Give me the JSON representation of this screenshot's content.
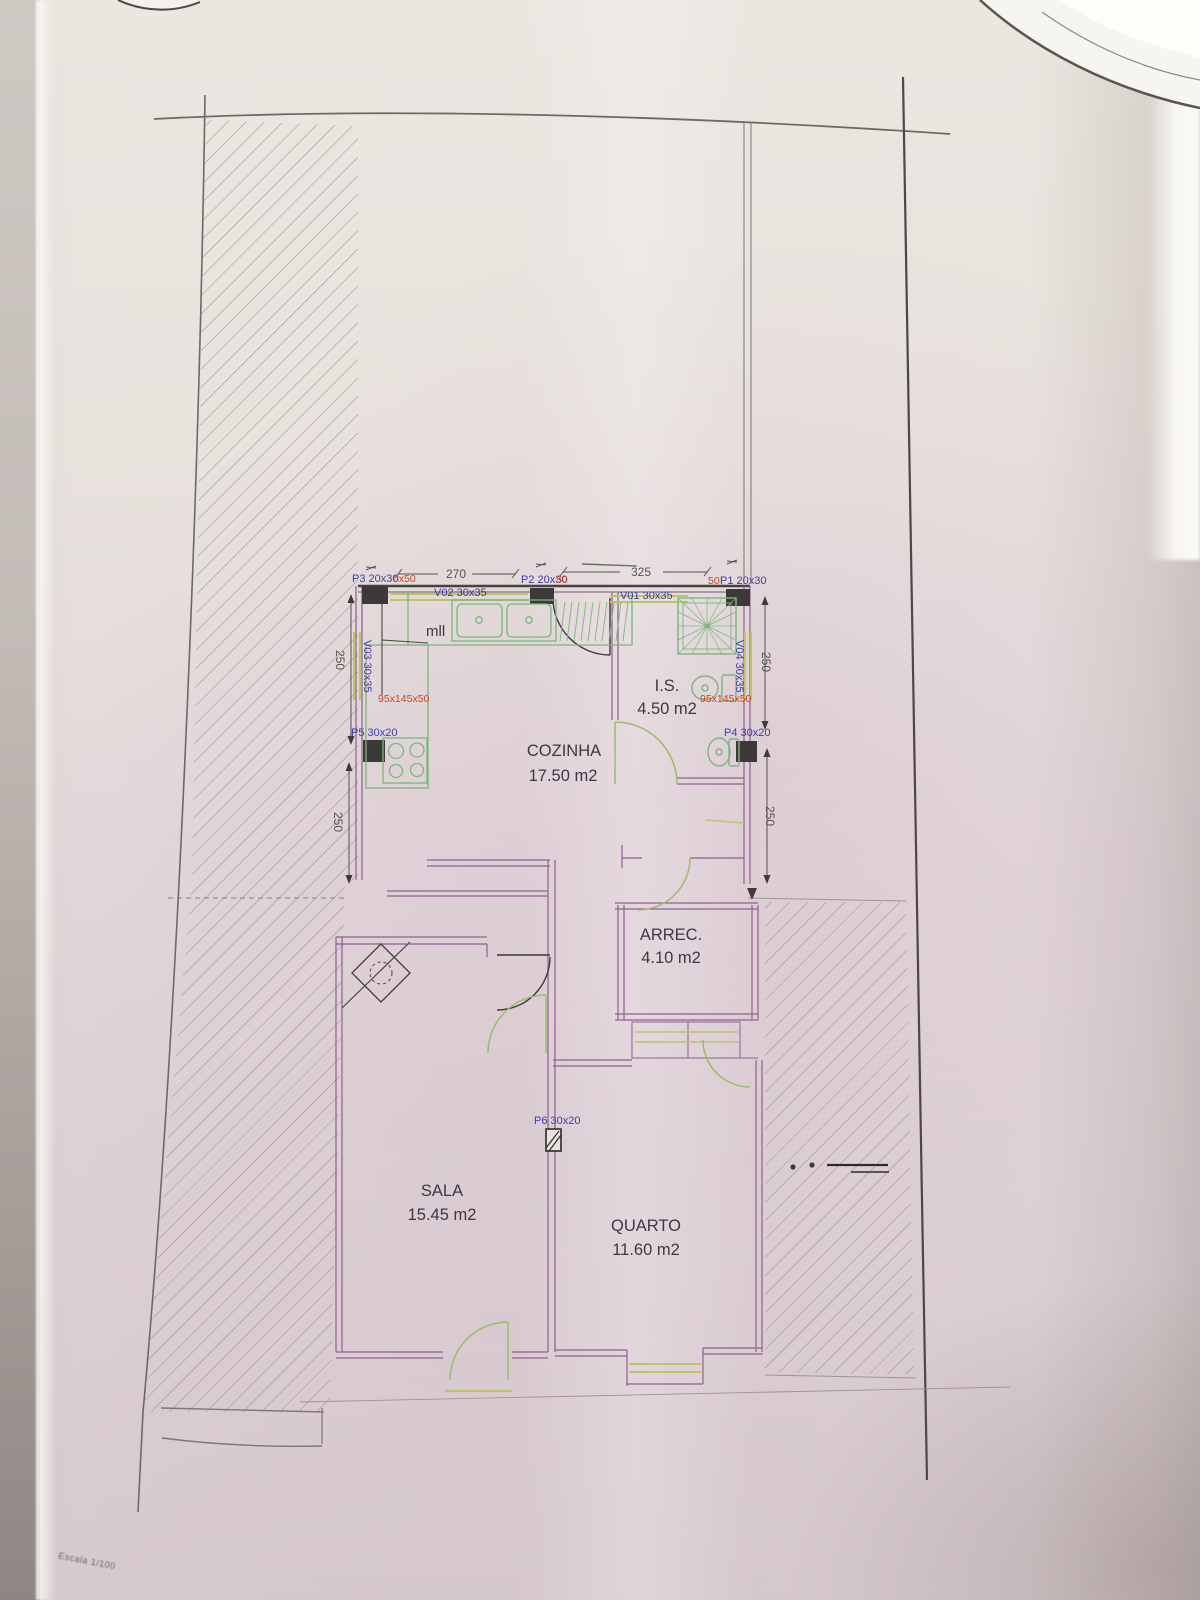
{
  "page": {
    "scale_note": "Escala 1/100"
  },
  "rooms": {
    "cozinha": {
      "name": "COZINHA",
      "area": "17.50 m2"
    },
    "is": {
      "name": "I.S.",
      "area": "4.50 m2"
    },
    "arrec": {
      "name": "ARREC.",
      "area": "4.10 m2"
    },
    "sala": {
      "name": "SALA",
      "area": "15.45 m2"
    },
    "quarto": {
      "name": "QUARTO",
      "area": "11.60 m2"
    }
  },
  "openings": {
    "p1": {
      "label": "P1 20x30",
      "red": "50"
    },
    "p2": {
      "label": "P2 20x30",
      "red": "50"
    },
    "p3": {
      "label": "P3 20x30",
      "red": "0x50"
    },
    "p4": {
      "label": "P4 30x20"
    },
    "p5": {
      "label": "P5 30x20"
    },
    "p6": {
      "label": "P6 30x20"
    },
    "v01": {
      "label": "V01 30x35"
    },
    "v02": {
      "label": "V02 30x35"
    },
    "v03": {
      "label": "V03 30x35"
    },
    "v04": {
      "label": "V04 30x35"
    }
  },
  "dimensions": {
    "top_left": "270",
    "top_right": "325",
    "left_upper": "250",
    "left_lower": "250",
    "right_upper": "250",
    "right_lower": "250"
  },
  "fixtures": {
    "counter_label": "mll",
    "left_red": "95x145x50",
    "right_red": "95x145x50"
  },
  "colors": {
    "wall_purple": "#8f5f8f",
    "wall_dark": "#46423e",
    "fixture_green": "#7db57d",
    "window_green": "#bdc468",
    "label_blue": "#3d3da8",
    "label_red": "#c8461e",
    "dim_gray": "#55524e",
    "hatch_gray": "#8f8f8b"
  }
}
